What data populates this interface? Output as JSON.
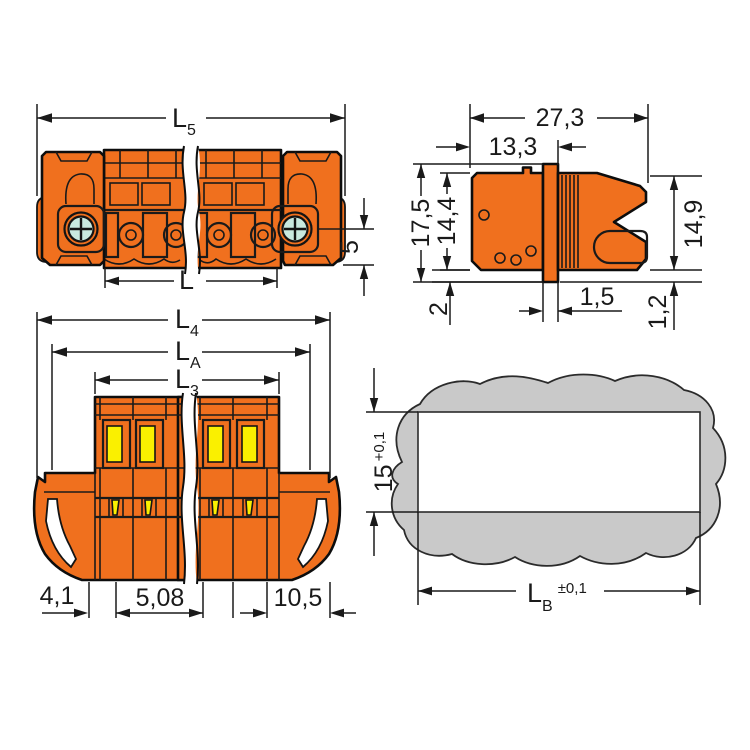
{
  "drawing": {
    "background": "#ffffff",
    "colors": {
      "body_orange": "#F0701E",
      "detail_yellow": "#FAF000",
      "screw_teal": "#C9E9DF",
      "panel_gray": "#C9C9C9",
      "line_dark": "#1A1A1A"
    },
    "top_view": {
      "dims": {
        "overall_length": {
          "base": "L",
          "sub": "5"
        },
        "pole_length": "L",
        "screw_center_height": "5"
      }
    },
    "side_view": {
      "dims": {
        "total_depth": "27,3",
        "rear_depth": "13,3",
        "flange_height": "17,5",
        "body_height": "14,4",
        "plug_height": "14,9",
        "flange_overhang": "2",
        "flange_thickness": "1,5",
        "edge_offset": "1,2"
      }
    },
    "front_view": {
      "dims": {
        "length_l4": {
          "base": "L",
          "sub": "4"
        },
        "length_la": {
          "base": "L",
          "sub": "A"
        },
        "length_l3": {
          "base": "L",
          "sub": "3"
        },
        "edge_to_pole": "4,1",
        "pole_pitch": "5,08",
        "end_width": "10,5"
      }
    },
    "panel_cutout_view": {
      "dims": {
        "cutout_height": {
          "value": "15",
          "tolerance": "+0,1"
        },
        "cutout_width": {
          "base": "L",
          "sub": "B",
          "tolerance": "±0,1"
        }
      }
    }
  }
}
